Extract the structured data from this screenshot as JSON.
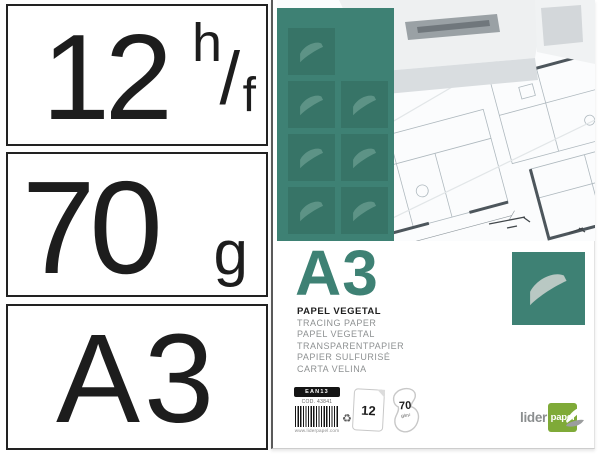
{
  "colors": {
    "teal": "#3e8174",
    "brand_green": "#7faa38",
    "ink": "#1d1d1d"
  },
  "spec_boxes": [
    {
      "value": "12",
      "unit_numerator": "h",
      "unit_slash": "/",
      "unit_denominator": "f"
    },
    {
      "value": "70",
      "unit": "g"
    },
    {
      "value": "A3"
    }
  ],
  "package": {
    "size_title": "A3",
    "product_name": "PAPEL VEGETAL",
    "translations": [
      "TRACING PAPER",
      "PAPEL VEGETAL",
      "TRANSPARENTPAPIER",
      "PAPIER SULFURISÉ",
      "CARTA VELINA"
    ],
    "label": {
      "barcode_header": "EAN13",
      "code": "COD. 43841",
      "website": "www.liderpapel.com"
    },
    "badges": {
      "sheet_count": "12",
      "weight": "70",
      "weight_unit": "g/m²",
      "recycle_symbol": "♻"
    },
    "brand": {
      "name_prefix": "lider",
      "name_suffix": "papel"
    }
  }
}
